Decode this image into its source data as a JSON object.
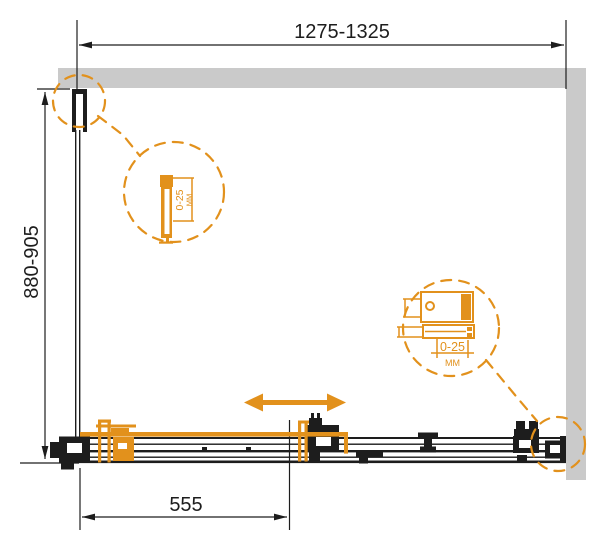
{
  "drawing": {
    "type": "shower-enclosure-plan",
    "dimensions": {
      "overall_width": "1275-1325",
      "overall_depth": "880-905",
      "door_panel_width": "555"
    },
    "details": {
      "left_profile": {
        "range": "0-25",
        "unit": "ММ"
      },
      "right_roller": {
        "range": "0-25",
        "unit": "ММ"
      }
    },
    "colors": {
      "accent": "#E2911C",
      "wall": "#CACACA",
      "line": "#1D1D1D",
      "background": "#FFFFFF"
    }
  }
}
